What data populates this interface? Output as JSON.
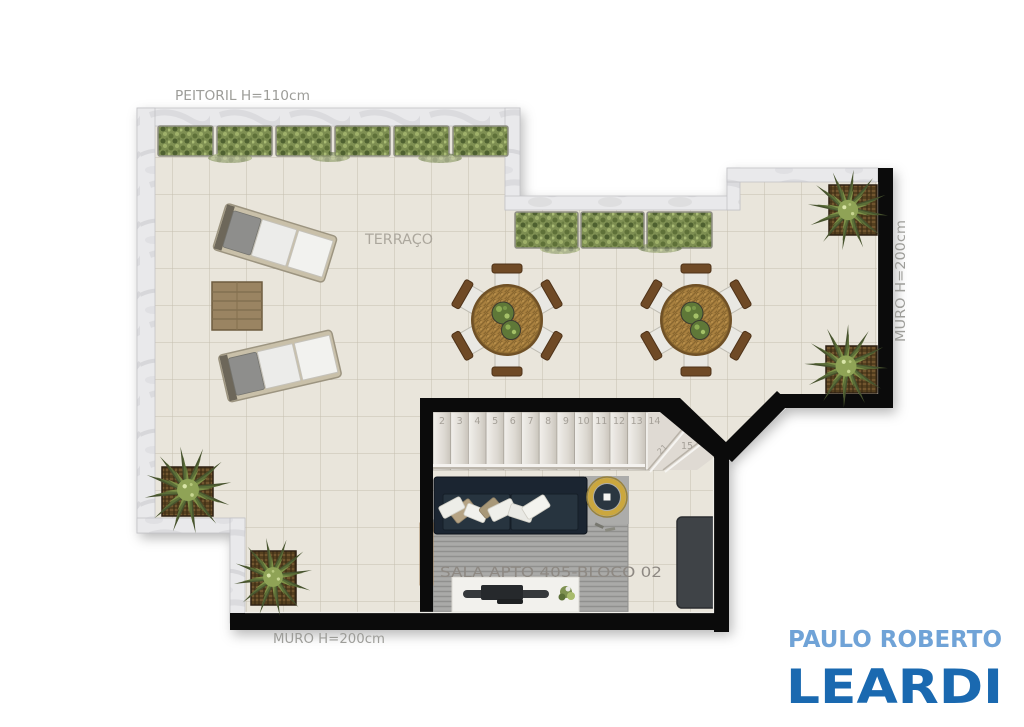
{
  "plan": {
    "labels": {
      "peitoril": "PEITORIL  H=110cm",
      "terraco": "TERRAÇO",
      "muro_right": "MURO  H=200cm",
      "muro_bottom": "MURO  H=200cm",
      "sala": "SALA  APTO  405-BLOCO  02"
    },
    "stairs": {
      "numbers": [
        "2",
        "3",
        "4",
        "5",
        "6",
        "7",
        "8",
        "9",
        "10",
        "11",
        "12",
        "13",
        "14"
      ],
      "winder_number": "15",
      "rotated_number": "21"
    }
  },
  "logo": {
    "line1": "PAULO ROBERTO",
    "line2": "LEARDI"
  },
  "colors": {
    "logo_light_blue": "#70a3d7",
    "logo_dark_blue": "#1a69b0",
    "wall_black": "#0b0b0b",
    "marble": "#e9e9eb",
    "tile_floor": "#e9e5db",
    "hedge_green": "#7e8f52",
    "rattan_brown": "#a8803f",
    "sofa_navy": "#1b2531",
    "gold": "#cba73e",
    "label_gray": "#9d9d99"
  }
}
